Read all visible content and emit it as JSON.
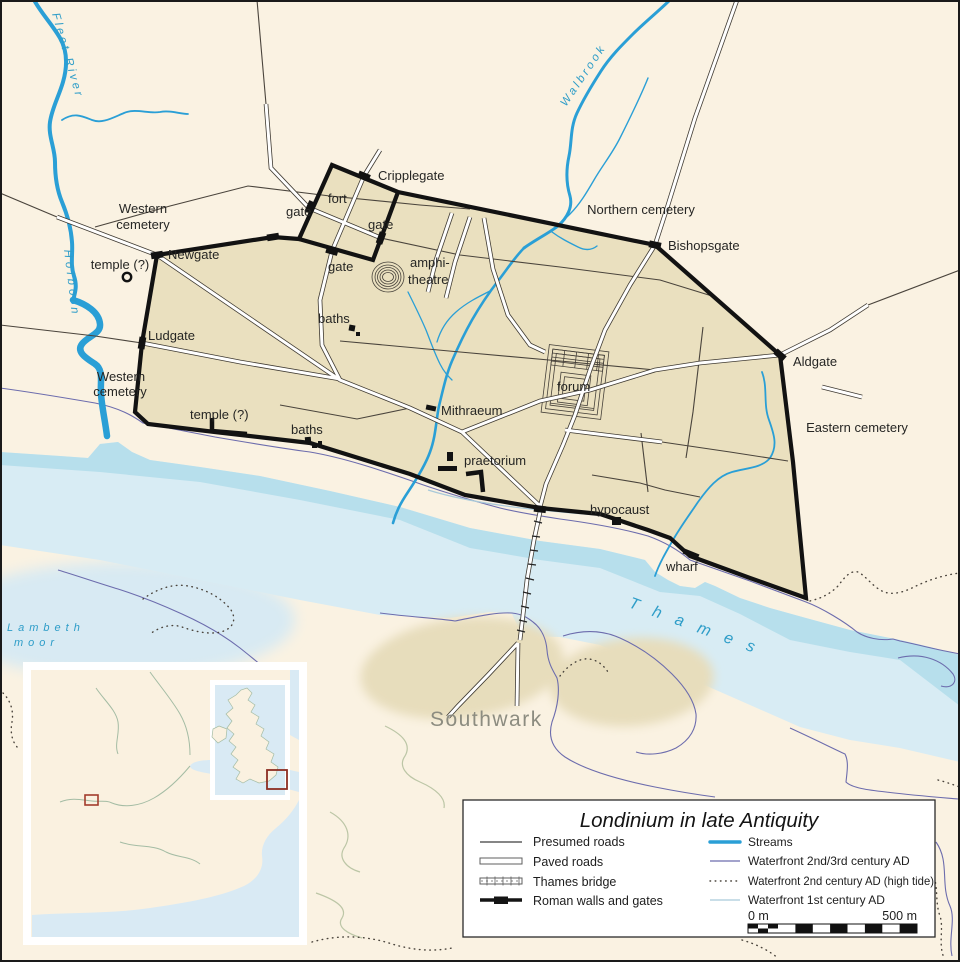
{
  "colors": {
    "background": "#FAF2E2",
    "city_fill": "#EAE0BF",
    "water_light": "#D8ECF4",
    "water_dark": "#B7DFEC",
    "stream": "#2A9FD6",
    "hydro": "#2E9DC8",
    "wall": "#121212",
    "waterfront_23c": "#6C6CAD",
    "waterfront_1c": "#A9C9D9",
    "marker_red": "#A23C2C",
    "southwark_label": "#8C8C80"
  },
  "map": {
    "labels": {
      "fleet_river": "Fleet River",
      "holborn": "Holborn",
      "walbrook": "Walbrook",
      "thames": "Thames",
      "lambeth_line1": "Lambeth",
      "lambeth_line2": "moor",
      "southwark": "Southwark",
      "western_cemetery_line1": "Western",
      "western_cemetery_line2": "cemetery",
      "northern_cemetery": "Northern cemetery",
      "eastern_cemetery": "Eastern cemetery",
      "newgate": "Newgate",
      "ludgate": "Ludgate",
      "cripplegate": "Cripplegate",
      "bishopsgate": "Bishopsgate",
      "aldgate": "Aldgate",
      "gate": "gate",
      "fort": "fort",
      "temple": "temple (?)",
      "amphitheatre_line1": "amphi-",
      "amphitheatre_line2": "theatre",
      "baths": "baths",
      "forum": "forum",
      "mithraeum": "Mithraeum",
      "praetorium": "praetorium",
      "hypocaust": "hypocaust",
      "wharf": "wharf"
    }
  },
  "legend": {
    "title": "Londinium in late Antiquity",
    "items_left": [
      "Presumed roads",
      "Paved roads",
      "Thames bridge",
      "Roman walls and gates"
    ],
    "items_right": [
      "Streams",
      "Waterfront 2nd/3rd century AD",
      "Waterfront 2nd century AD (high tide)",
      "Waterfront 1st century AD"
    ],
    "scale": {
      "start": "0 m",
      "end": "500 m"
    }
  }
}
